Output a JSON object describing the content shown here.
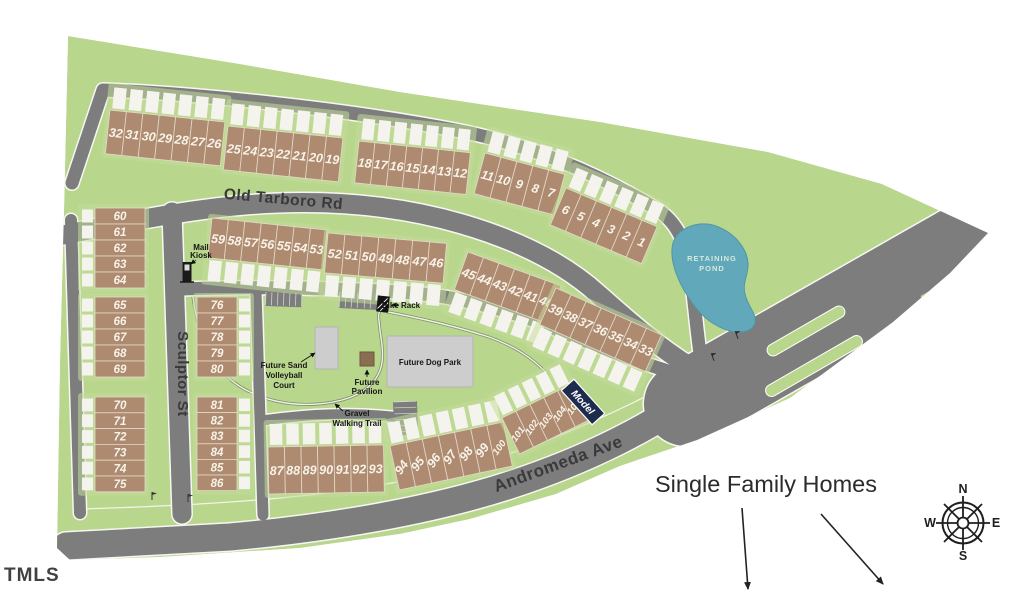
{
  "streets": {
    "old_tarboro_rd": "Old Tarboro Rd",
    "sculptor_st": "Sculptor St",
    "andromeda_ave": "Andromeda Ave"
  },
  "amenities": {
    "mail_kiosk": [
      "Mail",
      "Kiosk"
    ],
    "bike_rack": "Bike Rack",
    "volleyball": [
      "Future Sand",
      "Volleyball",
      "Court"
    ],
    "pavilion": [
      "Future",
      "Pavilion"
    ],
    "dog_park": "Future Dog Park",
    "trail": [
      "Gravel",
      "Walking Trail"
    ],
    "pond": [
      "RETAINING",
      "POND"
    ]
  },
  "annotations": {
    "model": "Model",
    "single_family_homes": "Single Family Homes",
    "watermark": "TMLS"
  },
  "compass": {
    "north": "N",
    "east": "E",
    "south": "S",
    "west": "W"
  },
  "lot_blocks": [
    {
      "id": "row-32-26",
      "numbers": [
        "32",
        "31",
        "30",
        "29",
        "28",
        "27",
        "26"
      ]
    },
    {
      "id": "row-25-19",
      "numbers": [
        "25",
        "24",
        "23",
        "22",
        "21",
        "20",
        "19"
      ]
    },
    {
      "id": "row-18-12",
      "numbers": [
        "18",
        "17",
        "16",
        "15",
        "14",
        "13",
        "12"
      ]
    },
    {
      "id": "row-11-7",
      "numbers": [
        "11",
        "10",
        "9",
        "8",
        "7"
      ]
    },
    {
      "id": "row-6-1",
      "numbers": [
        "6",
        "5",
        "4",
        "3",
        "2",
        "1"
      ]
    },
    {
      "id": "col-60-64",
      "numbers": [
        "60",
        "61",
        "62",
        "63",
        "64"
      ]
    },
    {
      "id": "col-65-69",
      "numbers": [
        "65",
        "66",
        "67",
        "68",
        "69"
      ]
    },
    {
      "id": "col-70-75",
      "numbers": [
        "70",
        "71",
        "72",
        "73",
        "74",
        "75"
      ]
    },
    {
      "id": "col-76-80",
      "numbers": [
        "76",
        "77",
        "78",
        "79",
        "80"
      ]
    },
    {
      "id": "col-81-86",
      "numbers": [
        "81",
        "82",
        "83",
        "84",
        "85",
        "86"
      ]
    },
    {
      "id": "row-59-53",
      "numbers": [
        "59",
        "58",
        "57",
        "56",
        "55",
        "54",
        "53"
      ]
    },
    {
      "id": "row-52-46",
      "numbers": [
        "52",
        "51",
        "50",
        "49",
        "48",
        "47",
        "46"
      ]
    },
    {
      "id": "row-45-40",
      "numbers": [
        "45",
        "44",
        "43",
        "42",
        "41",
        "40"
      ]
    },
    {
      "id": "row-39-33",
      "numbers": [
        "39",
        "38",
        "37",
        "36",
        "35",
        "34",
        "33"
      ]
    },
    {
      "id": "row-87-93",
      "numbers": [
        "87",
        "88",
        "89",
        "90",
        "91",
        "92",
        "93"
      ]
    },
    {
      "id": "row-94-100",
      "numbers": [
        "94",
        "95",
        "96",
        "97",
        "98",
        "99",
        "100"
      ]
    },
    {
      "id": "row-101-105",
      "numbers": [
        "101",
        "102",
        "103",
        "104",
        "105"
      ]
    }
  ],
  "colors": {
    "site_green": "#b8d68c",
    "pad_green": "#c3dc99",
    "road_gray": "#7d7d7d",
    "lot_brown": "#ae8b70",
    "lot_outline": "#e3d9c9",
    "driveway_white": "#f5f3ee",
    "pond_blue": "#61a8ba",
    "amenity_gray": "#cdcdcd",
    "pavilion_brown": "#8a6e52",
    "model_navy": "#1d2b4d"
  }
}
